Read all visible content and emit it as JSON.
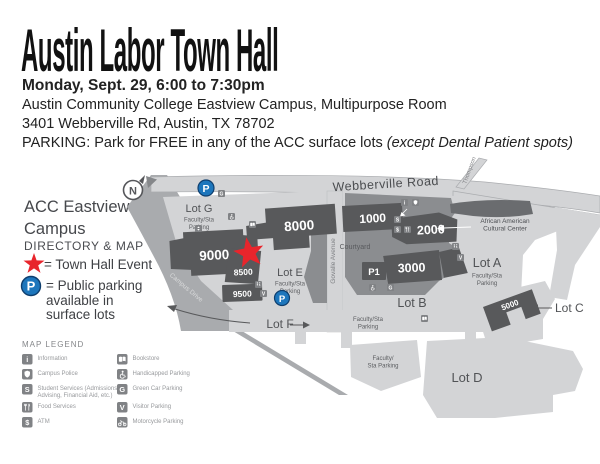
{
  "header": {
    "title": "Austin Labor Town Hall",
    "datetime": "Monday, Sept. 29, 6:00 to 7:30pm",
    "location": "Austin Community College Eastview Campus, Multipurpose Room",
    "address": "3401 Webberville Rd, Austin, TX 78702",
    "parking_prefix": "PARKING: Park for FREE in any of the ACC surface lots ",
    "parking_note": "(except Dental Patient spots)"
  },
  "sidebar": {
    "campus_name_line1": "ACC Eastview",
    "campus_name_line2": "Campus",
    "directory_label": "DIRECTORY & MAP",
    "star_legend": "= Town Hall Event",
    "parking_legend_line1": "= Public parking",
    "parking_legend_line2": "available in",
    "parking_legend_line3": "surface lots"
  },
  "map": {
    "compass": "N",
    "glyphs": {
      "p": "P",
      "info": "i",
      "services": "S",
      "atm": "$",
      "green": "G",
      "visitor": "V"
    },
    "streets": {
      "webberville": "Webberville Road",
      "thompson": "Thompson",
      "govalle": "Govalle Avenue",
      "campus_drive": "Campus Drive"
    },
    "buildings": {
      "b1000": "1000",
      "b2000": "2000",
      "b3000": "3000",
      "b5000": "5000",
      "b8000": "8000",
      "b8500": "8500",
      "b9000": "9000",
      "b9500": "9500",
      "p1": "P1"
    },
    "lots": {
      "a": "Lot A",
      "b": "Lot B",
      "c": "Lot C",
      "d": "Lot D",
      "e": "Lot E",
      "f": "Lot F",
      "g": "Lot G"
    },
    "labels": {
      "faculty_sta": "Faculty/Sta",
      "parking": "Parking",
      "faculty": "Faculty/",
      "sta_parking": "Sta  Parking",
      "courtyard": "Courtyard",
      "cultural1": "African American",
      "cultural2": "Cultural Center"
    }
  },
  "legend": {
    "title": "MAP LEGEND",
    "left": [
      {
        "icon": "information-icon",
        "label": "Information"
      },
      {
        "icon": "campus-police-icon",
        "label": "Campus Police"
      },
      {
        "icon": "student-services-icon",
        "label": "Student Services (Admissions,",
        "label2": "Advising, Financial Aid, etc.)"
      },
      {
        "icon": "food-services-icon",
        "label": "Food Services"
      },
      {
        "icon": "atm-icon",
        "label": "ATM"
      }
    ],
    "right": [
      {
        "icon": "bookstore-icon",
        "label": "Bookstore"
      },
      {
        "icon": "handicapped-parking-icon",
        "label": "Handicapped Parking"
      },
      {
        "icon": "green-car-parking-icon",
        "label": "Green Car Parking"
      },
      {
        "icon": "visitor-parking-icon",
        "label": "Visitor Parking"
      },
      {
        "icon": "motorcycle-parking-icon",
        "label": "Motorcycle Parking"
      }
    ]
  },
  "colors": {
    "accent_red": "#e8252c",
    "parking_blue": "#1d76bc",
    "building_gray": "#58595b",
    "road_gray": "#a9abae",
    "lot_gray": "#d3d4d6",
    "interior_gray": "#8b8d90"
  }
}
